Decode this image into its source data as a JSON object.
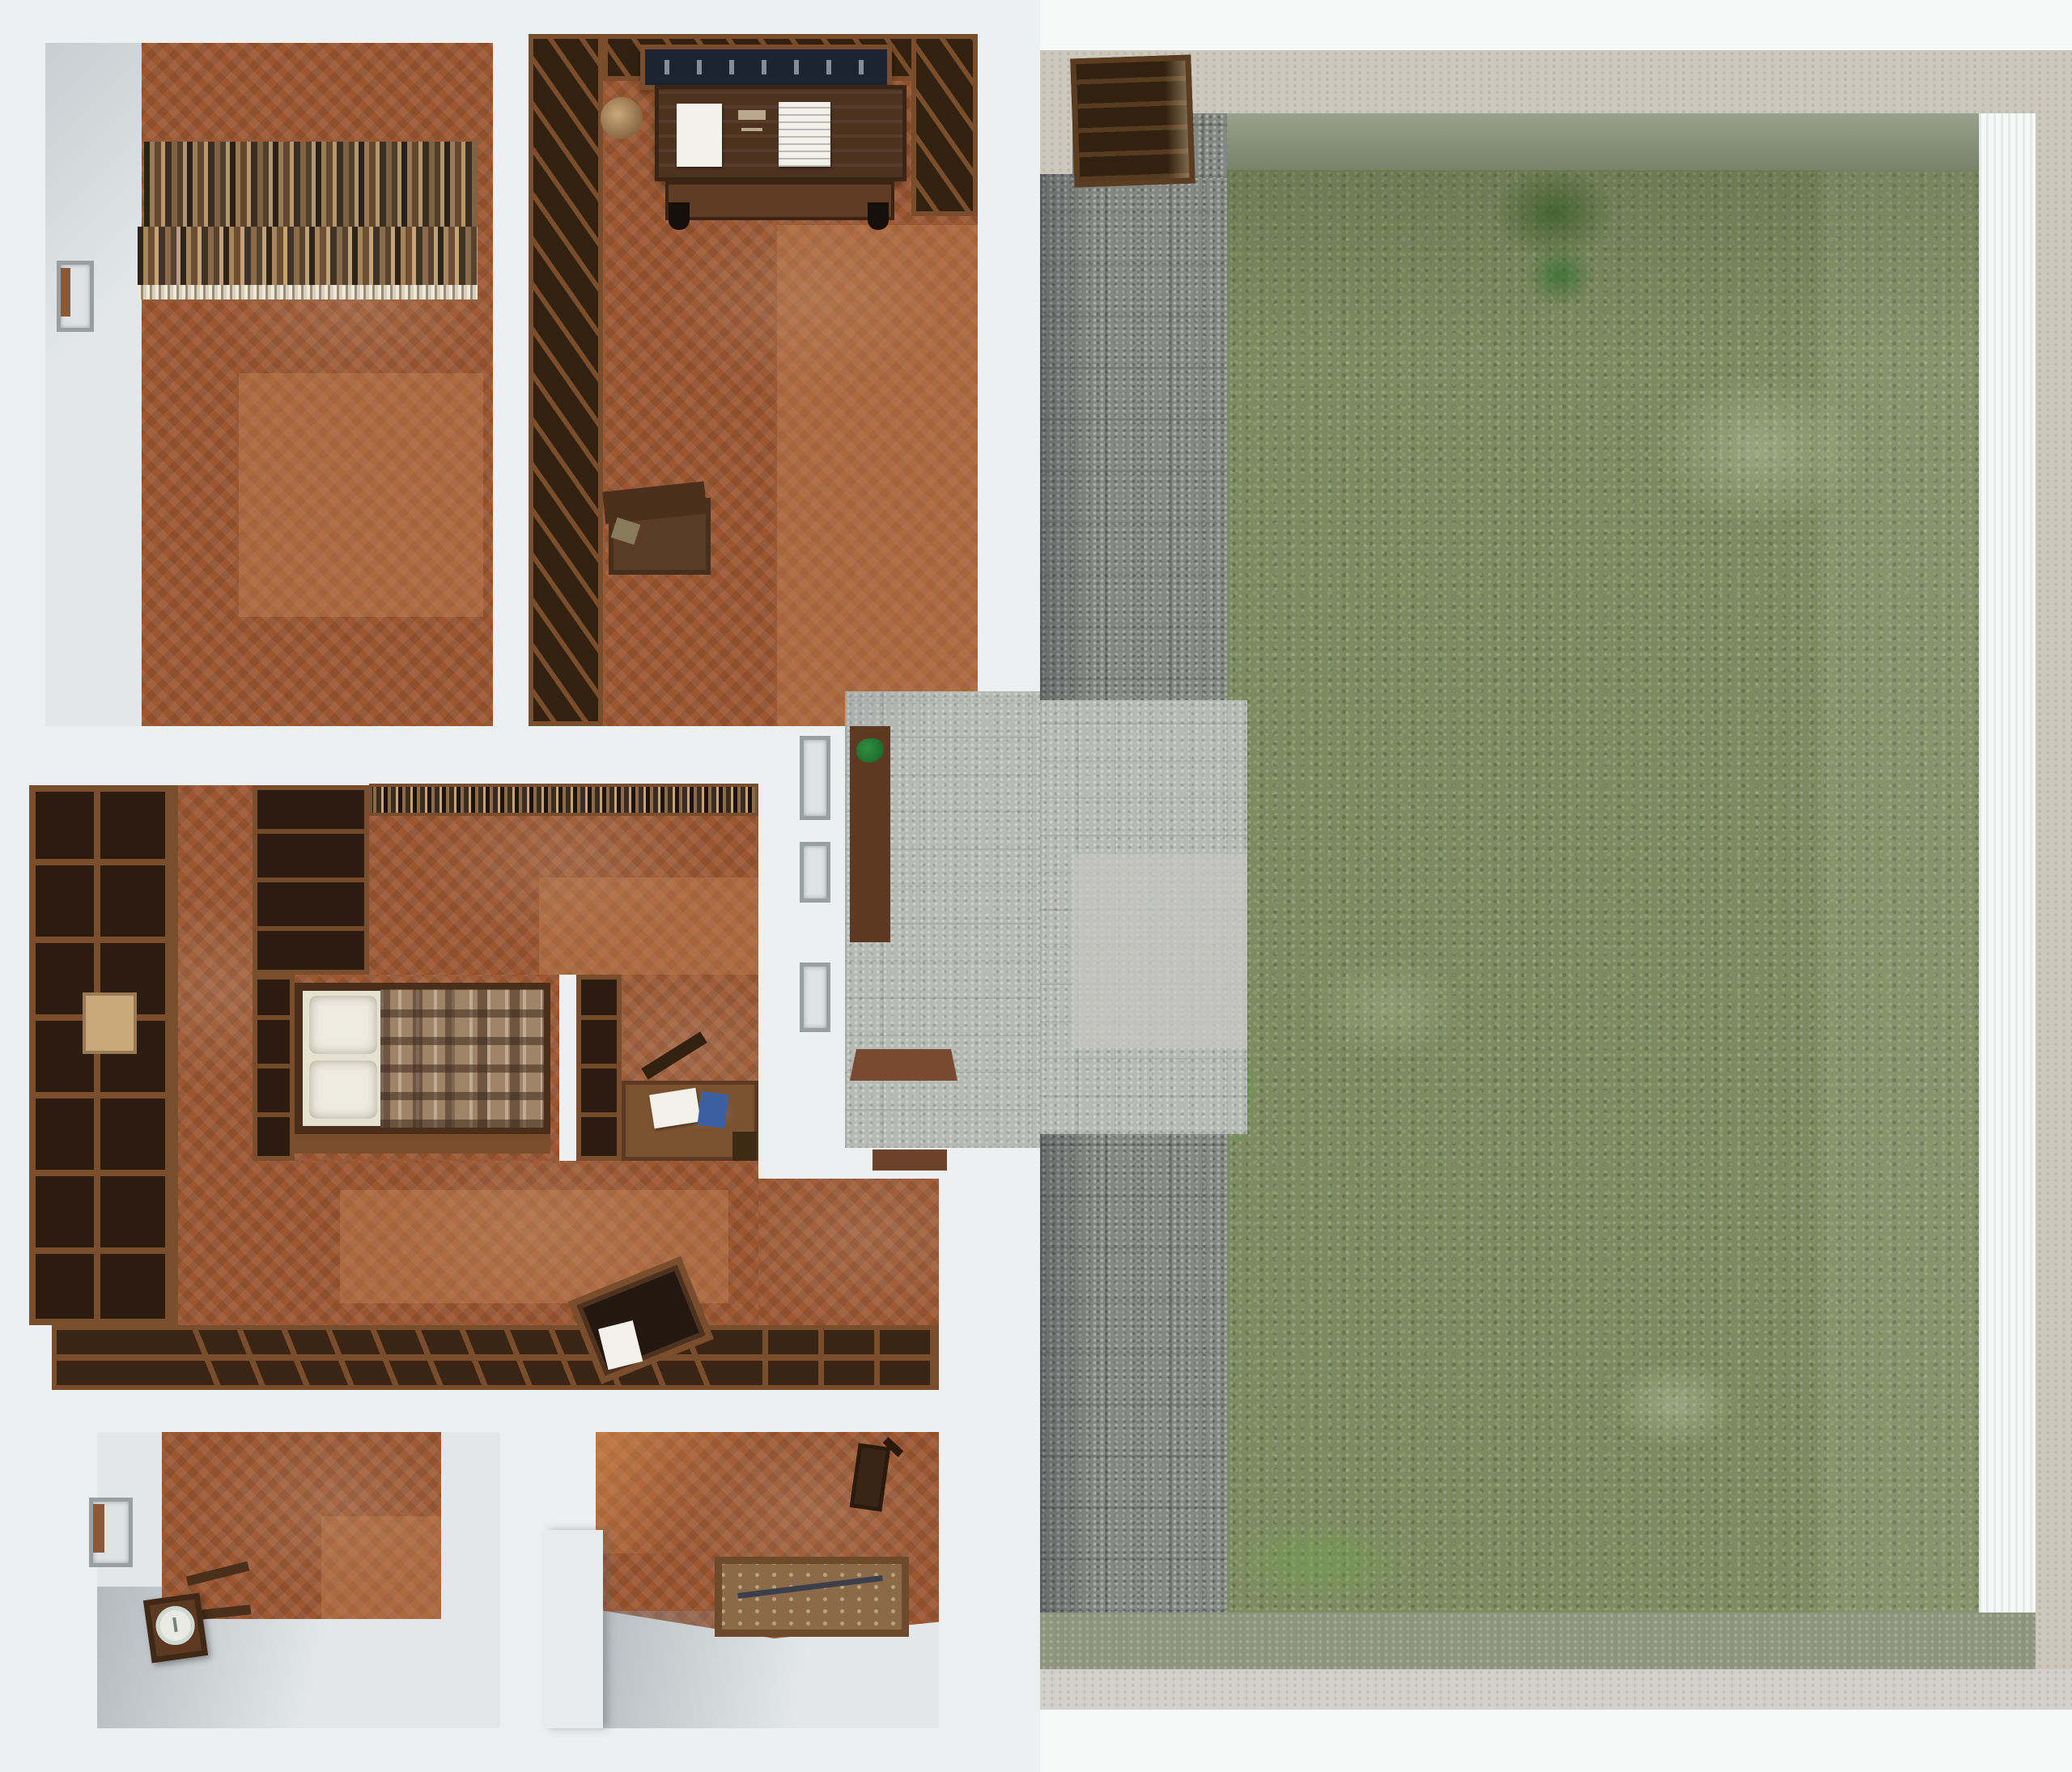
{
  "meta": {
    "title": "Top-down 3D render of a furnished house floor plan with walled courtyard garden",
    "view": "orthographic top-down",
    "left_half": "house interior with six spaces",
    "right_half": "courtyard with stone path and lawn"
  },
  "palette": {
    "page-bg": "#f7f8f8",
    "slab": "#edf0f0",
    "floor-white": "#e3e7e8",
    "parquet": "#9c5731",
    "parquet-highlight": "#c98a58",
    "wood-dark": "#33210f",
    "wood-mid": "#5c3a22",
    "wood-frame": "#7a4e2c",
    "desk-top": "#4e3220",
    "paper": "#f2f1ea",
    "painting-navy": "#1b2430",
    "pillow": "#efece0",
    "blanket": "#a08468",
    "stone-hall": "#b7b9b4",
    "stone-terrace": "#c5c7c2",
    "path-gray": "#848783",
    "grass": "#7d8c60",
    "grass-bright": "#4e9a44",
    "grass-light": "#b8bd9a",
    "wall-stone": "#ccc9bc",
    "wall-inner": "#9aa08c",
    "wall-moss": "#8f947f",
    "wall-right-inner": "#a9ad9f",
    "plant-green": "#2f8f3f",
    "blue-book": "#3b5fa0",
    "clock-face": "#e9eae2",
    "mat-brown": "#7a4a30"
  },
  "house": {
    "rooms": [
      {
        "id": "library-room",
        "label": "library room",
        "furniture": [
          "row of books along north wall",
          "window niche west wall",
          "two-tone parquet floor"
        ]
      },
      {
        "id": "study-room-north",
        "label": "north study",
        "furniture": [
          "framed dark painting",
          "writing desk with two papers",
          "wall bookshelves",
          "open floor crate"
        ]
      },
      {
        "id": "living-area",
        "label": "central living area",
        "furniture": [
          "tall bookcase west wall",
          "wall shelf with books",
          "low slanted shelf row",
          "tilted lectern with paper"
        ]
      },
      {
        "id": "bedroom",
        "label": "bedroom",
        "furniture": [
          "bed with two pillows and plaid blanket",
          "side bookshelf"
        ]
      },
      {
        "id": "small-study",
        "label": "small study nook",
        "furniture": [
          "corner bookshelf",
          "desk with paper and blue book",
          "stool"
        ]
      },
      {
        "id": "entry-hall",
        "label": "entry hall",
        "furniture": [
          "console table with plant",
          "three wall frames",
          "door mat"
        ]
      },
      {
        "id": "bottom-left-room",
        "label": "southwest room",
        "furniture": [
          "fallen long-case clock",
          "window niche"
        ]
      },
      {
        "id": "bottom-middle-room",
        "label": "south room",
        "furniture": [
          "storage crate with contents",
          "small chair",
          "partition wall"
        ]
      }
    ]
  },
  "courtyard": {
    "features": [
      "wooden gate in north wall",
      "gray flagstone path along house",
      "light paved terrace at entry",
      "large lawn",
      "stone perimeter walls on north, east and south"
    ]
  }
}
